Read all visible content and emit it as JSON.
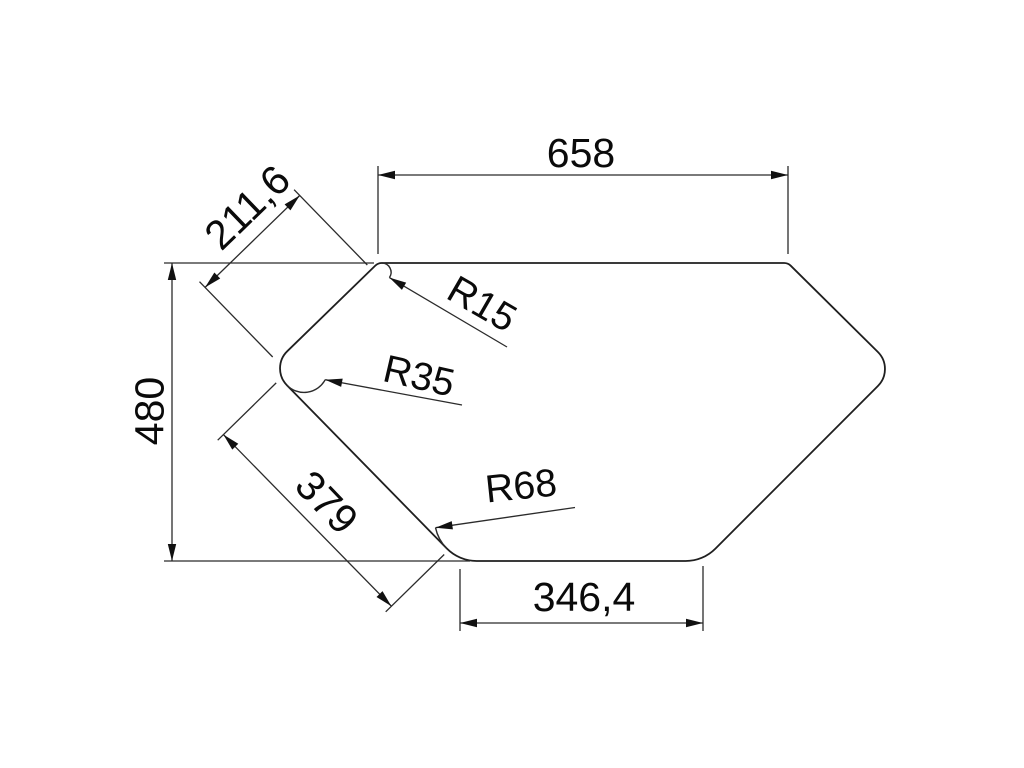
{
  "drawing": {
    "type": "technical-dimension-drawing",
    "shape": "hexagonal corner-sink outline with rounded corners",
    "colors": {
      "background": "#ffffff",
      "line": "#1f1f1f",
      "text": "#0a0a0a"
    },
    "dims": {
      "top_width": "658",
      "upper_left_edge": "211,6",
      "height": "480",
      "lower_left_edge": "379",
      "bottom_width": "346,4"
    },
    "radii": {
      "top_left_corner": "R15",
      "left_vertex": "R35",
      "bottom_left_corner": "R68"
    }
  }
}
